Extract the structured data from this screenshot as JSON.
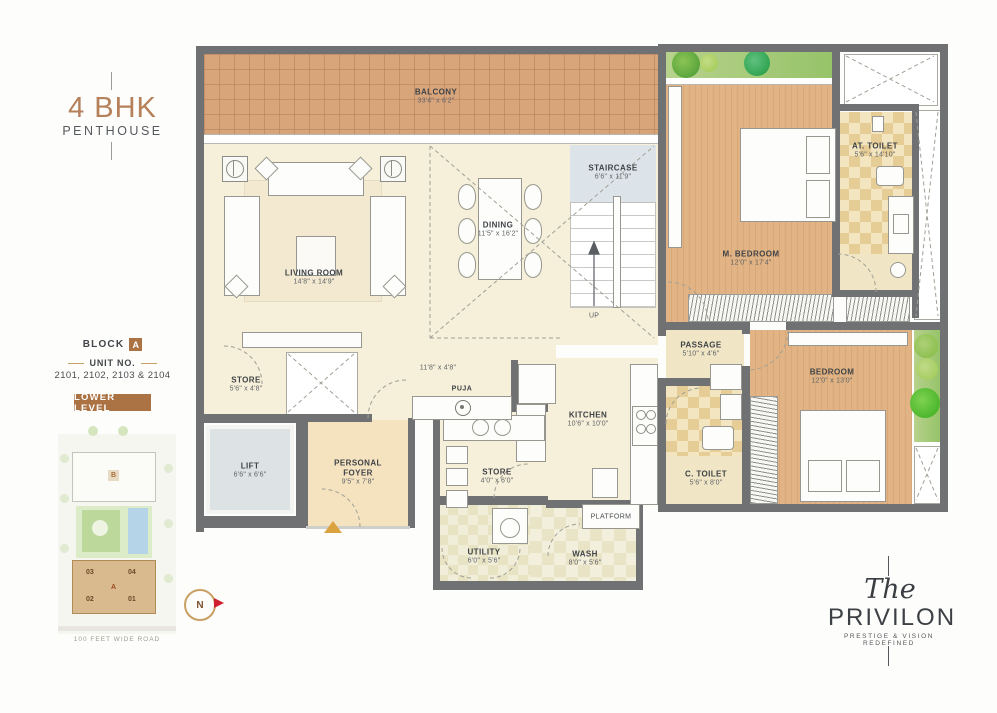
{
  "panel": {
    "title": "4 BHK",
    "subtitle": "PENTHOUSE",
    "block_label": "BLOCK",
    "block_value": "A",
    "unit_label": "UNIT NO.",
    "unit_numbers": "2101, 2102, 2103 & 2104",
    "level_badge": "LOWER LEVEL"
  },
  "keyplan": {
    "block_b": "B",
    "block_a": "A",
    "units": [
      "03",
      "04",
      "02",
      "01"
    ],
    "road": "100 FEET WIDE ROAD",
    "compass": "N"
  },
  "rooms": [
    {
      "name": "BALCONY",
      "dims": "33'4\" x 6'2\""
    },
    {
      "name": "LIVING ROOM",
      "dims": "14'8\" x 14'9\""
    },
    {
      "name": "DINING",
      "dims": "11'5\" x 16'2\""
    },
    {
      "name": "STAIRCASE",
      "dims": "6'6\" x 11'9\""
    },
    {
      "name": "M. BEDROOM",
      "dims": "12'0\" x 17'4\""
    },
    {
      "name": "AT. TOILET",
      "dims": "5'6\" x 14'10\""
    },
    {
      "name": "PASSAGE",
      "dims": "5'10\" x 4'6\""
    },
    {
      "name": "BEDROOM",
      "dims": "12'0\" x 13'0\""
    },
    {
      "name": "C. TOILET",
      "dims": "5'6\" x 8'0\""
    },
    {
      "name": "STORE",
      "dims": "5'6\" x 4'8\""
    },
    {
      "name": "LIFT",
      "dims": "6'6\" x 6'6\""
    },
    {
      "name": "PERSONAL FOYER",
      "dims": "9'5\" x 7'8\""
    },
    {
      "name": "KITCHEN",
      "dims": "10'6\" x 10'0\""
    },
    {
      "name": "STORE",
      "dims": "4'0\" x 6'0\""
    },
    {
      "name": "UTILITY",
      "dims": "6'0\" x 5'6\""
    },
    {
      "name": "WASH",
      "dims": "8'0\" x 5'6\""
    }
  ],
  "labels": {
    "up": "UP",
    "puja": "PUJA",
    "platform": "PLATFORM",
    "corridor_dims": "11'8\" x 4'8\""
  },
  "logo": {
    "the": "The",
    "name": "PRIVILON",
    "tagline": "PRESTIGE & VISION REDEFINED"
  },
  "colors": {
    "accent_brown": "#ab7243",
    "title_brown": "#b5805a",
    "gold": "#c9a063",
    "wall_gray": "#6f7173",
    "balcony_tile": "#d8a57b",
    "wood_floor": "#e2b485",
    "compass_red": "#cf2030",
    "entry_arrow": "#dca23f"
  }
}
